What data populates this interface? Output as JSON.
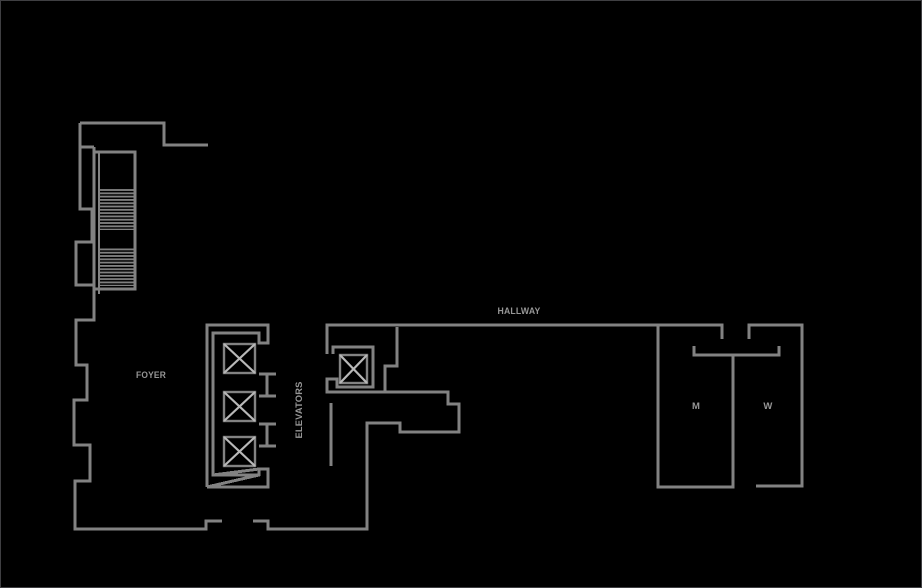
{
  "plan": {
    "labels": {
      "foyer": "FOYER",
      "elevators": "ELEVATORS",
      "hallway": "HALLWAY",
      "mens_restroom": "M",
      "womens_restroom": "W"
    }
  },
  "colors": {
    "background": "#000000",
    "wall": "#828282",
    "elevator_x": "#b8b8b8",
    "label_text": "#969696",
    "border": "#3f3f42"
  }
}
